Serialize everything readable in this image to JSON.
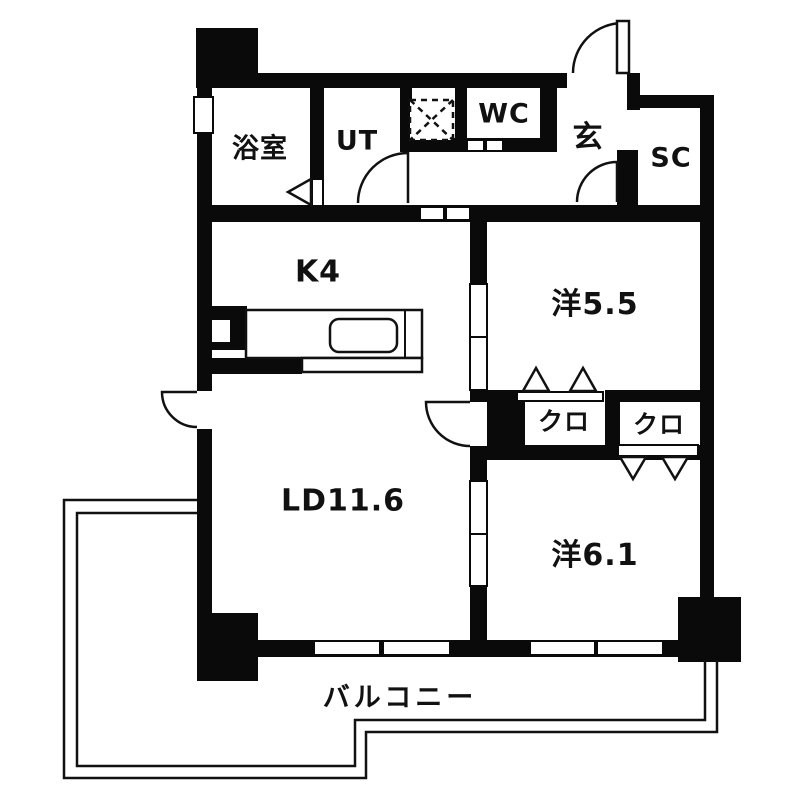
{
  "floorplan": {
    "rooms": {
      "bath": "浴室",
      "utility": "UT",
      "toilet": "WC",
      "entrance": "玄",
      "shoe_closet": "SC",
      "kitchen": "K4",
      "western_room_1": "洋5.5",
      "closet_1": "クロ",
      "closet_2": "クロ",
      "living_dining": "LD11.6",
      "western_room_2": "洋6.1",
      "balcony": "バルコニー"
    },
    "colors": {
      "wall": "#0a0a0a",
      "floor": "#ffffff",
      "line": "#111111"
    }
  }
}
